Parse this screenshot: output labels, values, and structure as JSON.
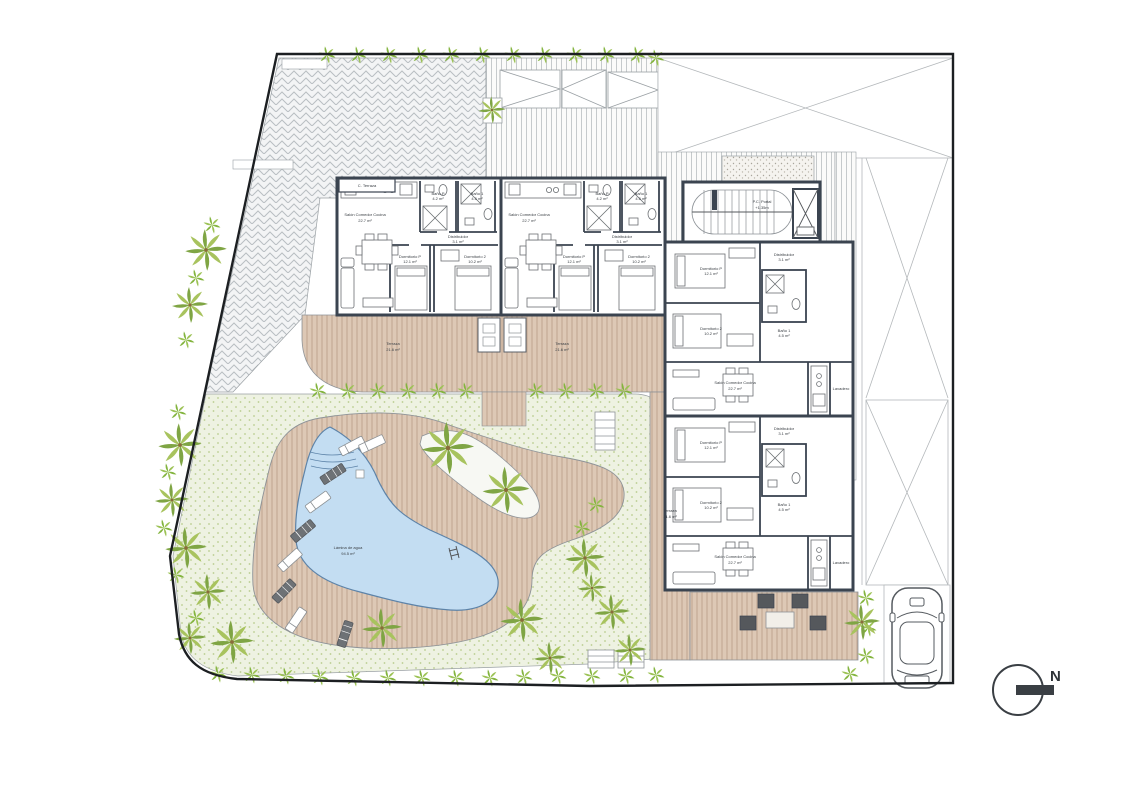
{
  "site": {
    "entry_label": "P.C. Portal",
    "entry_level": "+1.35m",
    "terrace_store_label": "C. Terraza",
    "pool_label": "Lámina de agua",
    "pool_area": "94.5 m²",
    "north_label": "N"
  },
  "rooms": {
    "salon": "Salón Comedor Cocina",
    "salon_area": "22.7 m²",
    "distribuidor": "Distribuidor",
    "distribuidor_area": "3.1 m²",
    "bano_p": "Baño P",
    "bano_p_area": "4.2 m²",
    "bano_1": "Baño 1",
    "bano_1_area": "4.5 m²",
    "dormitorio_p": "Dormitorio P",
    "dormitorio_p_area": "12.1 m²",
    "dormitorio_2": "Dormitorio 2",
    "dormitorio_2_area": "10.2 m²",
    "terraza": "Terraza",
    "terraza_area": "21.6 m²",
    "lavadero": "Lavadero"
  },
  "colors": {
    "wall": "#3b4450",
    "thin_line": "#8e9398",
    "deck_wood": "#ddc8b5",
    "deck_wood_line": "#bb9f8a",
    "lawn": "#eef2e2",
    "lawn_dot": "#b9cc8e",
    "pool_water": "#c3ddf2",
    "pool_edge": "#5d83a8",
    "palm_green_dark": "#7fa544",
    "palm_green_light": "#a8c35e",
    "bush_green": "#83b43e",
    "hatch_gray": "#b9bec2",
    "stripe_gray": "#c6cacc"
  }
}
